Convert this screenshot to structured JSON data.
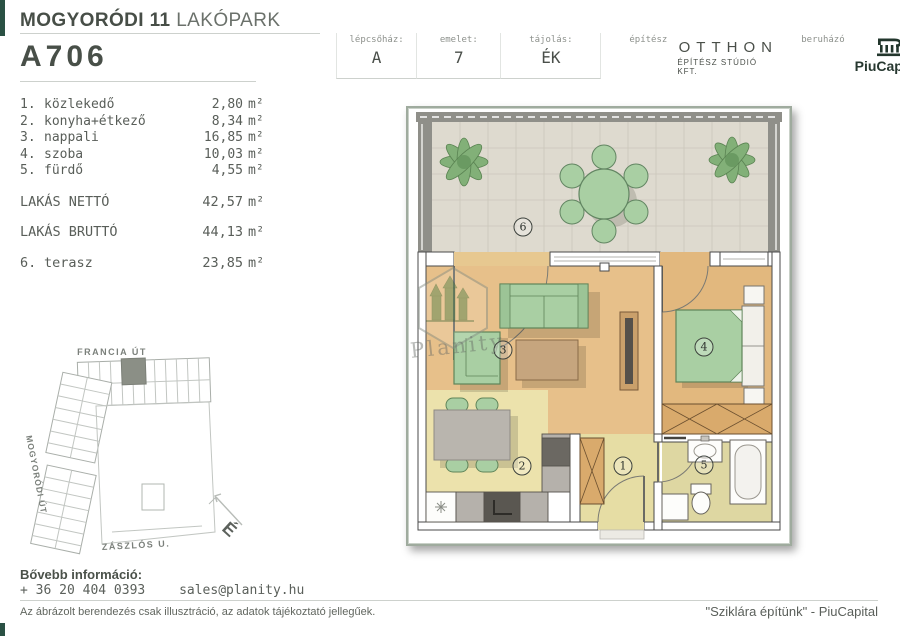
{
  "header": {
    "project_bold": "MOGYORÓDI 11",
    "project_regular": "LAKÓPARK",
    "unit_id": "A706",
    "info": {
      "staircase_label": "lépcsőház:",
      "staircase_value": "A",
      "floor_label": "emelet:",
      "floor_value": "7",
      "orientation_label": "tájolás:",
      "orientation_value": "ÉK",
      "architect_label": "építész",
      "architect_name": "OTTHON",
      "architect_sub": "ÉPÍTÉSZ STÚDIÓ KFT.",
      "developer_label": "beruházó",
      "developer_name": "PiuCapital"
    }
  },
  "room_list": {
    "rooms": [
      {
        "no": "1.",
        "name": "közlekedő",
        "area": "2,80",
        "unit": "m²"
      },
      {
        "no": "2.",
        "name": "konyha+étkező",
        "area": "8,34",
        "unit": "m²"
      },
      {
        "no": "3.",
        "name": "nappali",
        "area": "16,85",
        "unit": "m²"
      },
      {
        "no": "4.",
        "name": "szoba",
        "area": "10,03",
        "unit": "m²"
      },
      {
        "no": "5.",
        "name": "fürdő",
        "area": "4,55",
        "unit": "m²"
      }
    ],
    "net_label": "LAKÁS NETTÓ",
    "net_area": "42,57",
    "net_unit": "m²",
    "gross_label": "LAKÁS BRUTTÓ",
    "gross_area": "44,13",
    "gross_unit": "m²",
    "terrace_no": "6.",
    "terrace_name": "terasz",
    "terrace_area": "23,85",
    "terrace_unit": "m²"
  },
  "site_plan": {
    "street_top": "FRANCIA ÚT",
    "street_left": "MOGYORÓDI ÚT",
    "street_bottom": "ZÁSZLÓS U.",
    "compass": "É"
  },
  "floor_plan": {
    "watermark": "Planity",
    "markers": [
      {
        "number": "1"
      },
      {
        "number": "2"
      },
      {
        "number": "3"
      },
      {
        "number": "4"
      },
      {
        "number": "5"
      },
      {
        "number": "6"
      }
    ]
  },
  "footer": {
    "info_label": "Bővebb információ:",
    "phone": "+ 36 20 404 0393",
    "email": "sales@planity.hu",
    "disclaimer": "Az ábrázolt berendezés csak illusztráció, az adatok tájékoztató jellegűek.",
    "slogan": "\"Sziklára építünk\" - PiuCapital"
  },
  "colors": {
    "accent_green_dark": "#2a5144",
    "furniture_green": "#a9cfa3",
    "wood_floor": "#e7c08a",
    "frame_green": "#9fab9e"
  }
}
